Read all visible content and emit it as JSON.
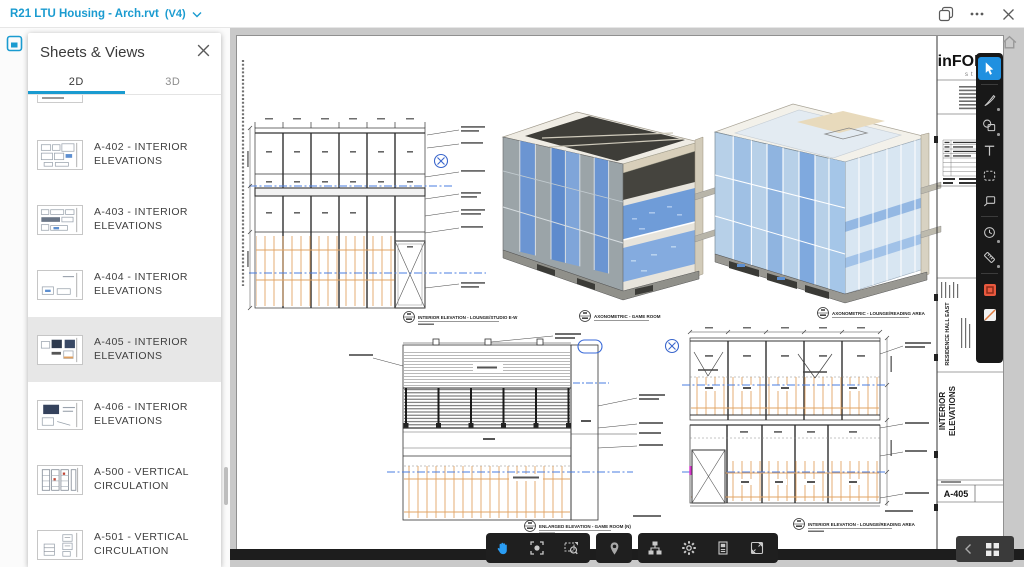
{
  "titlebar": {
    "title": "R21 LTU Housing - Arch.rvt",
    "version": "(V4)"
  },
  "panel": {
    "title": "Sheets & Views",
    "tabs": [
      {
        "label": "2D"
      },
      {
        "label": "3D"
      }
    ],
    "active_tab": "2D",
    "items": [
      {
        "label": "A-402 - INTERIOR ELEVATIONS",
        "selected": false
      },
      {
        "label": "A-403 - INTERIOR ELEVATIONS",
        "selected": false
      },
      {
        "label": "A-404 - INTERIOR ELEVATIONS",
        "selected": false
      },
      {
        "label": "A-405 - INTERIOR ELEVATIONS",
        "selected": true
      },
      {
        "label": "A-406 - INTERIOR ELEVATIONS",
        "selected": false
      },
      {
        "label": "A-500 - VERTICAL CIRCULATION",
        "selected": false
      },
      {
        "label": "A-501 - VERTICAL CIRCULATION",
        "selected": false
      }
    ]
  },
  "sheet": {
    "logo": "inFORM",
    "logo_sub": "studio",
    "project_name": "RESIDENCE HALL EAST",
    "sheet_title_line1": "INTERIOR",
    "sheet_title_line2": "ELEVATIONS",
    "sheet_number": "A-405",
    "captions": {
      "elev_lounge_studio": "INTERIOR ELEVATION - LOUNGE/STUDIO E-W",
      "axon_game": "AXONOMETRIC - GAME ROOM",
      "axon_lounge": "AXONOMETRIC - LOUNGE/READING AREA",
      "enlarged_game": "ENLARGED ELEVATION - GAME ROOM (N)",
      "elev_lounge_reading": "INTERIOR ELEVATION - LOUNGE/READING AREA"
    }
  },
  "colors": {
    "accent": "#1a9bd0",
    "selected_tool": "#2090e0",
    "canvas_bg": "#c9c9c9",
    "hatch_orange": "#e2a464",
    "centerline_blue": "#4a7de0",
    "swatch_red": "#e8593f"
  }
}
